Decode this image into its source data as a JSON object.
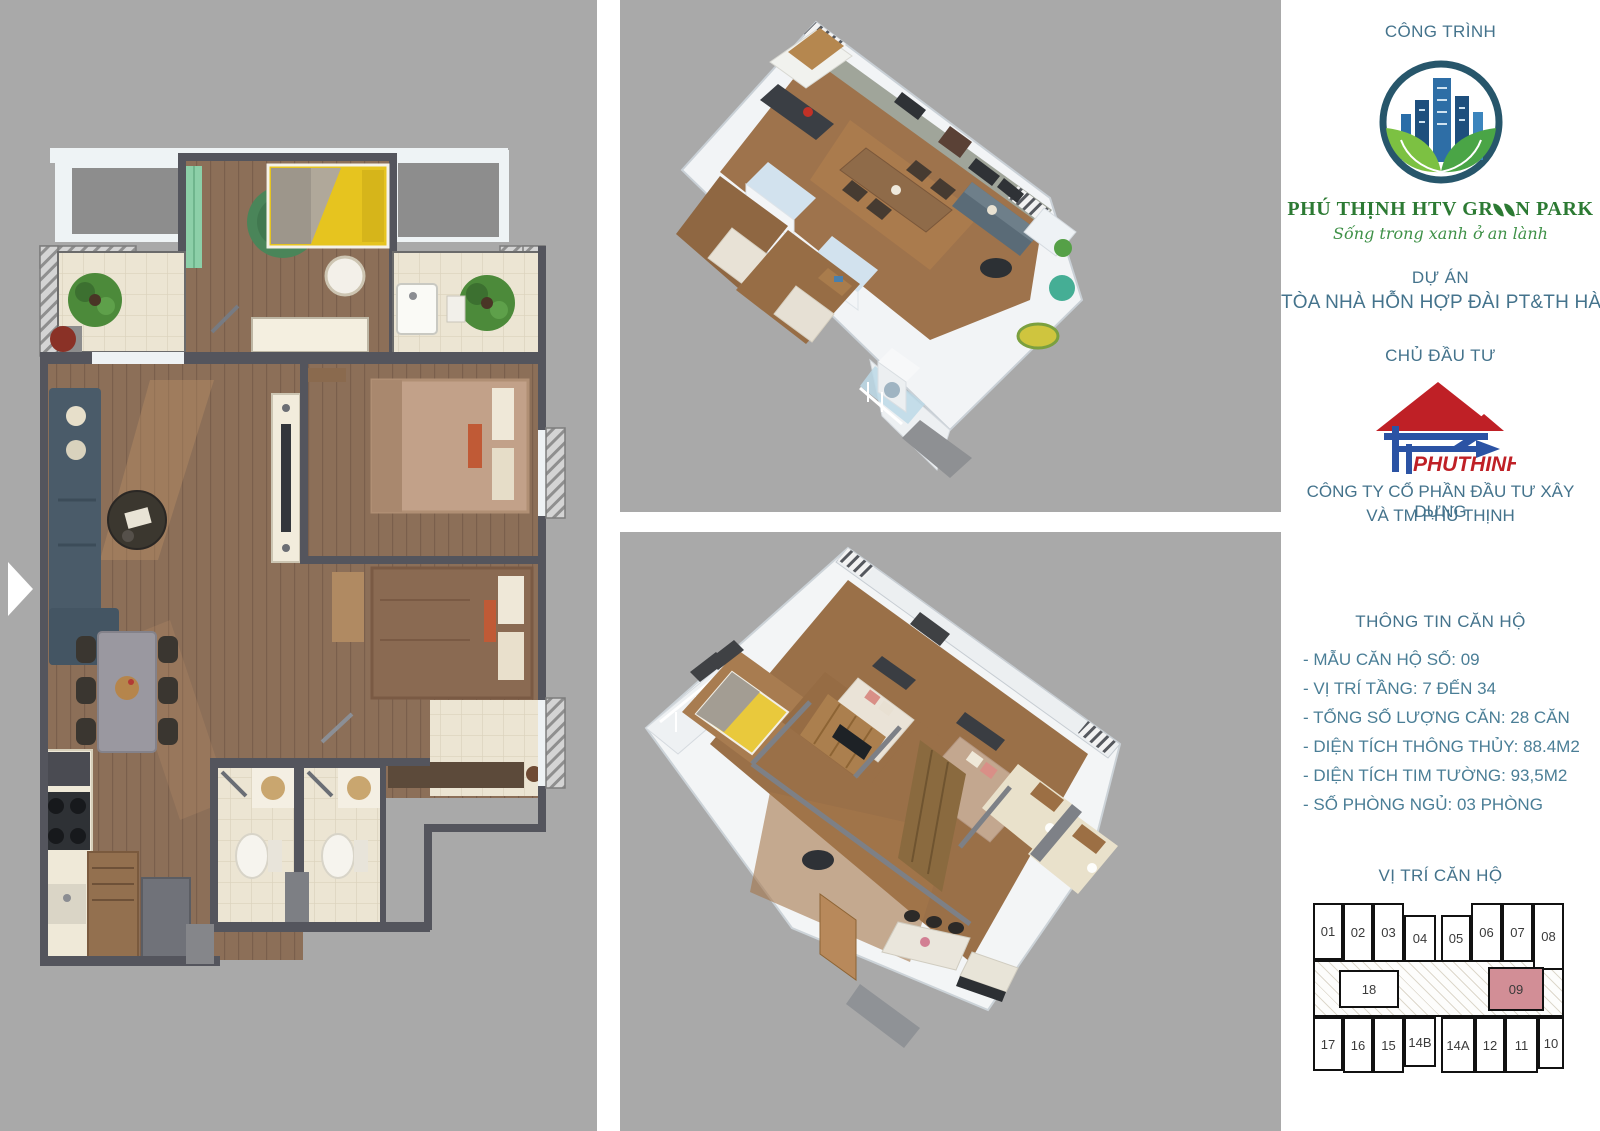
{
  "right_panel": {
    "cong_trinh_label": "CÔNG TRÌNH",
    "brand": {
      "left": "PHÚ THỊNH HTV GR",
      "right": "N PARK",
      "tagline": "Sống trong xanh ở an lành"
    },
    "du_an_label": "DỰ ÁN",
    "du_an_name": "TÒA NHÀ HỖN HỢP ĐÀI PT&TH HÀ NỘI",
    "chu_dau_tu_label": "CHỦ ĐẦU TƯ",
    "developer_logo_text": "PHUTHINH",
    "company_line1": "CÔNG TY CỔ PHẦN ĐẦU TƯ XÂY DỰNG",
    "company_line2": "VÀ TM PHÚ THỊNH",
    "thong_tin_label": "THÔNG TIN CĂN HỘ",
    "info_items": [
      "- MẪU CĂN HỘ SỐ: 09",
      "- VỊ TRÍ TẦNG: 7 ĐẾN 34",
      "- TỔNG SỐ LƯỢNG CĂN: 28 CĂN",
      "- DIỆN TÍCH THÔNG THỦY: 88.4M2",
      "- DIỆN TÍCH TIM TƯỜNG: 93,5M2",
      "- SỐ PHÒNG NGỦ: 03 PHÒNG"
    ],
    "vi_tri_label": "VỊ TRÍ CĂN HỘ",
    "unit_map": {
      "highlighted_unit": "09",
      "highlight_color": "#d28e96",
      "top_row": [
        "01",
        "02",
        "03",
        "04",
        "05",
        "06",
        "07",
        "08"
      ],
      "middle_row": [
        "18",
        "09"
      ],
      "bottom_row": [
        "17",
        "16",
        "15",
        "14B",
        "14A",
        "12",
        "11",
        "10"
      ]
    }
  },
  "colors": {
    "panel_bg": "#a9a9a9",
    "heading_blue": "#44738c",
    "info_blue": "#4a7e96",
    "brand_green": "#2c7a33",
    "tagline_green": "#3f9148",
    "developer_red": "#bf2026",
    "developer_blue": "#2b53a4",
    "highlight_pink": "#d28e96"
  }
}
